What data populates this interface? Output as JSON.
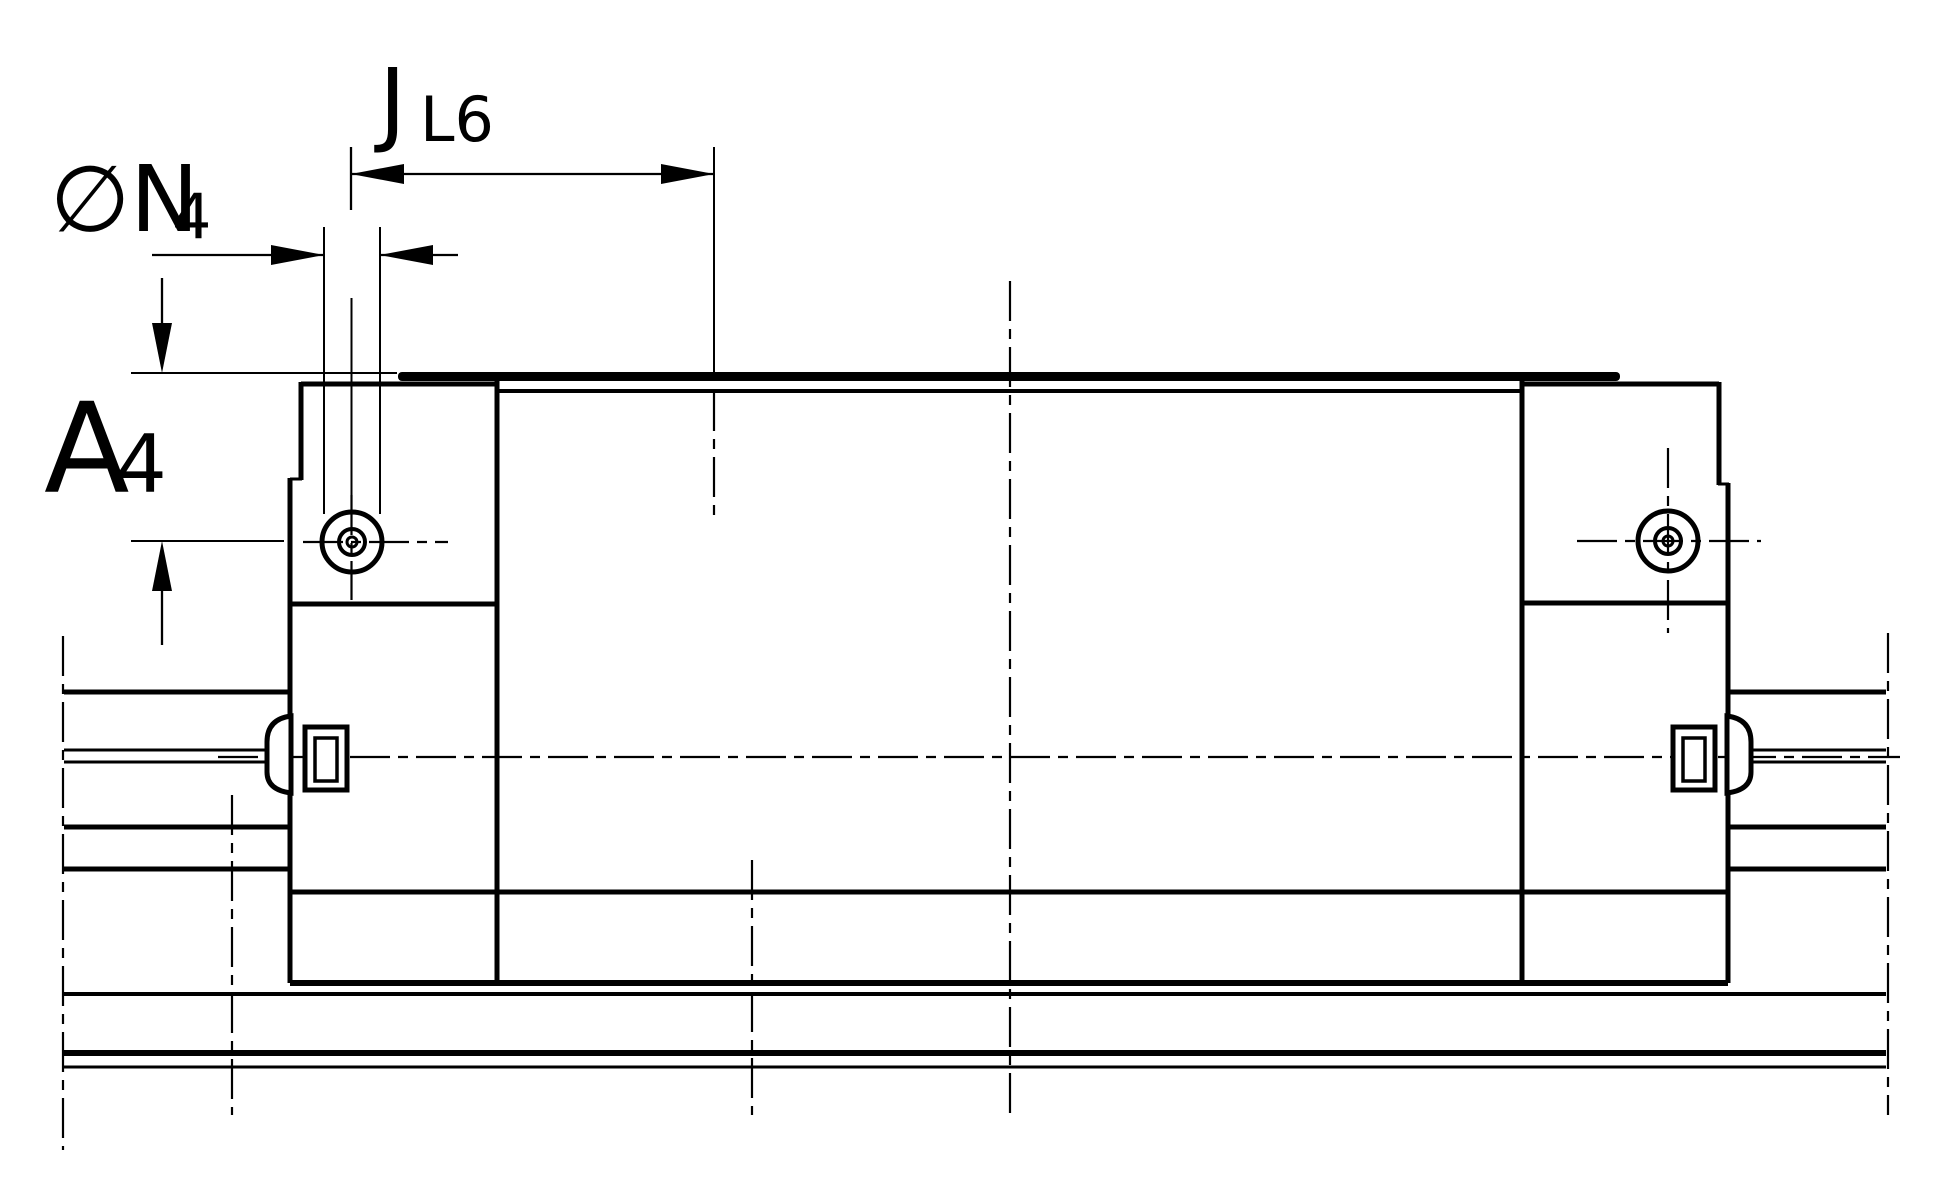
{
  "drawing": {
    "type": "technical-drawing",
    "subject": "linear guide carriage on rail, side elevation",
    "colors": {
      "line": "#000000",
      "background": "#ffffff"
    }
  },
  "dimension_labels": {
    "horizontal_top": {
      "main": "J",
      "subscript": "L6"
    },
    "hole_diameter": {
      "main": "∅N",
      "subscript": "4"
    },
    "vertical_left": {
      "main": "A",
      "subscript": "4"
    }
  }
}
